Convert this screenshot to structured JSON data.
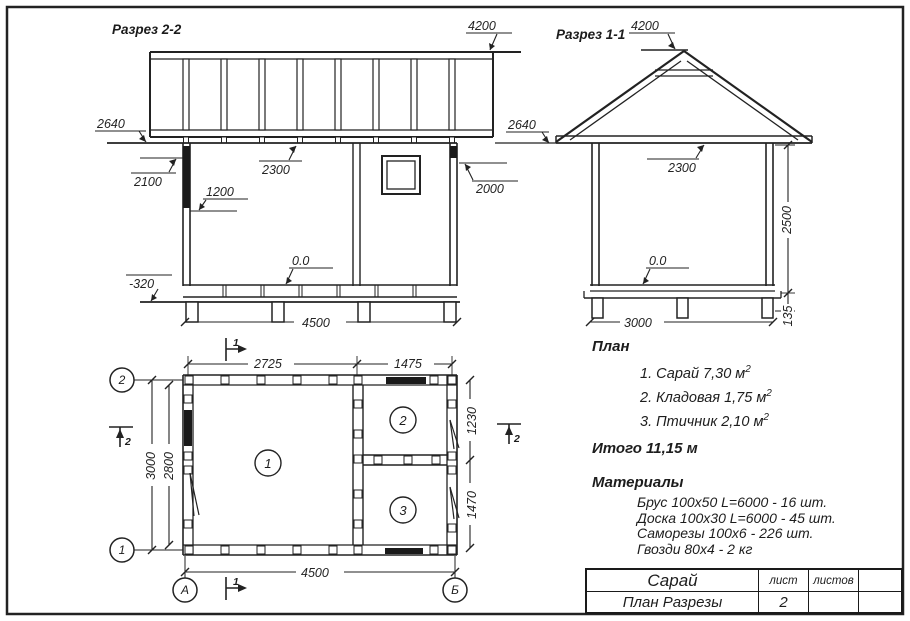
{
  "section22": {
    "title": "Разрез 2-2",
    "elev_4200": "4200",
    "elev_2640": "2640",
    "elev_2100": "2100",
    "elev_1200": "1200",
    "elev_2300": "2300",
    "elev_2000": "2000",
    "elev_zero": "0.0",
    "elev_minus320": "-320",
    "dim_4500": "4500"
  },
  "section11": {
    "title": "Разрез 1-1",
    "elev_4200": "4200",
    "elev_2640": "2640",
    "elev_2300": "2300",
    "elev_zero": "0.0",
    "dim_3000": "3000",
    "dim_2500": "2500",
    "dim_135": "135"
  },
  "plan": {
    "dim_2725": "2725",
    "dim_1475": "1475",
    "dim_3000": "3000",
    "dim_2800": "2800",
    "dim_1230": "1230",
    "dim_1470": "1470",
    "dim_4500": "4500",
    "axis_1": "1",
    "axis_2": "2",
    "axis_a": "А",
    "axis_b": "Б",
    "room_1": "1",
    "room_2": "2",
    "room_3": "3",
    "cut_mark_1": "1",
    "cut_mark_2": "2"
  },
  "notes": {
    "plan_heading": "План",
    "rooms": [
      {
        "text": "1. Сарай 7,30 м",
        "sup": "2"
      },
      {
        "text": "2. Кладовая 1,75 м",
        "sup": "2"
      },
      {
        "text": "3. Птичник 2,10 м",
        "sup": "2"
      }
    ],
    "total": "Итого 11,15 м",
    "materials_heading": "Материалы",
    "materials": [
      "Брус 100х50 L=6000 - 16 шт.",
      "Доска 100х30 L=6000 - 45 шт.",
      "Саморезы 100х6 - 226 шт.",
      "Гвозди 80х4 - 2 кг"
    ]
  },
  "title_block": {
    "object": "Сарай",
    "doc": "План Разрезы",
    "sheet_label": "лист",
    "sheets_label": "листов",
    "sheet_number": "2"
  }
}
